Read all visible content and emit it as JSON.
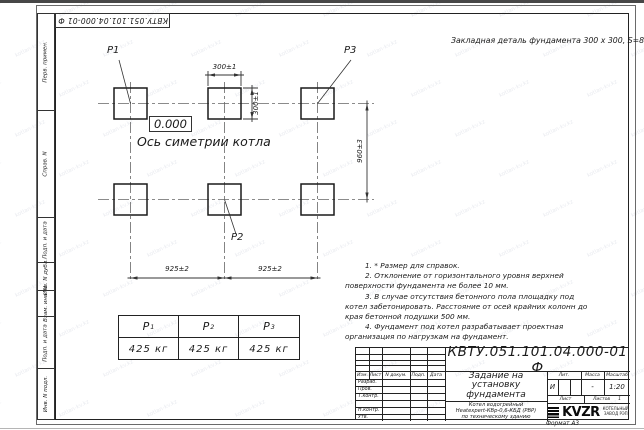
{
  "watermark": {
    "text": "kotlan-kv.kz"
  },
  "corner_stamp": {
    "doc_number": "КВТУ.051.101.04.000-01  Ф"
  },
  "margin_stamps": {
    "items": [
      "Перв. примен.",
      "Справ. N",
      "Подп. и дата",
      "Инв. N дубл.",
      "Взам. инв. N",
      "Подп. и дата",
      "Инв. N подл."
    ]
  },
  "drawing": {
    "embed_note": "Закладная деталь фундамента  300 х 300,  S=8;",
    "elevation": "0.000",
    "axis_label": "Ось симетрии котла",
    "point_labels": {
      "p1": "P1",
      "p2": "P2",
      "p3": "P3"
    },
    "dimensions": {
      "plate_width": "300±1",
      "plate_height": "300±1",
      "row_spacing": "960±3",
      "span_left": "925±2",
      "span_right": "925±2"
    }
  },
  "notes": {
    "items": [
      "1.  * Размер для справок.",
      "2. Отклонение от горизонтального уровня верхней поверхности фундамента не более 10 мм.",
      "3. В случае отсутствия бетонного пола площадку под котел забетонировать. Расстояние от осей крайних колонн до края бетонной подушки 500 мм.",
      "4. Фундамент под котел разрабатывает проектная организация по нагрузкам на фундамент."
    ]
  },
  "load_table": {
    "columns": [
      {
        "label": "P",
        "sub": "1",
        "value": "425 кг"
      },
      {
        "label": "P",
        "sub": "2",
        "value": "425 кг"
      },
      {
        "label": "P",
        "sub": "3",
        "value": "425 кг"
      }
    ]
  },
  "title_block": {
    "doc_number": "КВТУ.051.101.04.000-01  Ф",
    "title_lines": [
      "Задание на",
      "установку",
      "фундамента"
    ],
    "product_lines": [
      "Котел водогрейный",
      "Heatexpert-КВр-0,6-КБД (РВР)",
      "по техническому зданию"
    ],
    "header_cols": {
      "izm": "Изм.",
      "list": "Лист",
      "doc": "N докум.",
      "podp": "Подп.",
      "data": "Дата"
    },
    "rows": [
      "Разраб.",
      "Пров.",
      "Т.контр.",
      "",
      "Н.контр.",
      "Утв."
    ],
    "lit_label": "Лит.",
    "mass_label": "Масса",
    "scale_label": "Масштаб",
    "lit_value": "И",
    "mass_value": "-",
    "scale_value": "1:20",
    "sheet_label": "Лист",
    "sheets_label": "Листов",
    "sheets_value": "1",
    "logo": {
      "text": "KVZR",
      "sub_line1": "КОТЕЛЬНЫЙ",
      "sub_line2": "ЗАВОД РЭП"
    },
    "format_label": "Формат А3"
  }
}
